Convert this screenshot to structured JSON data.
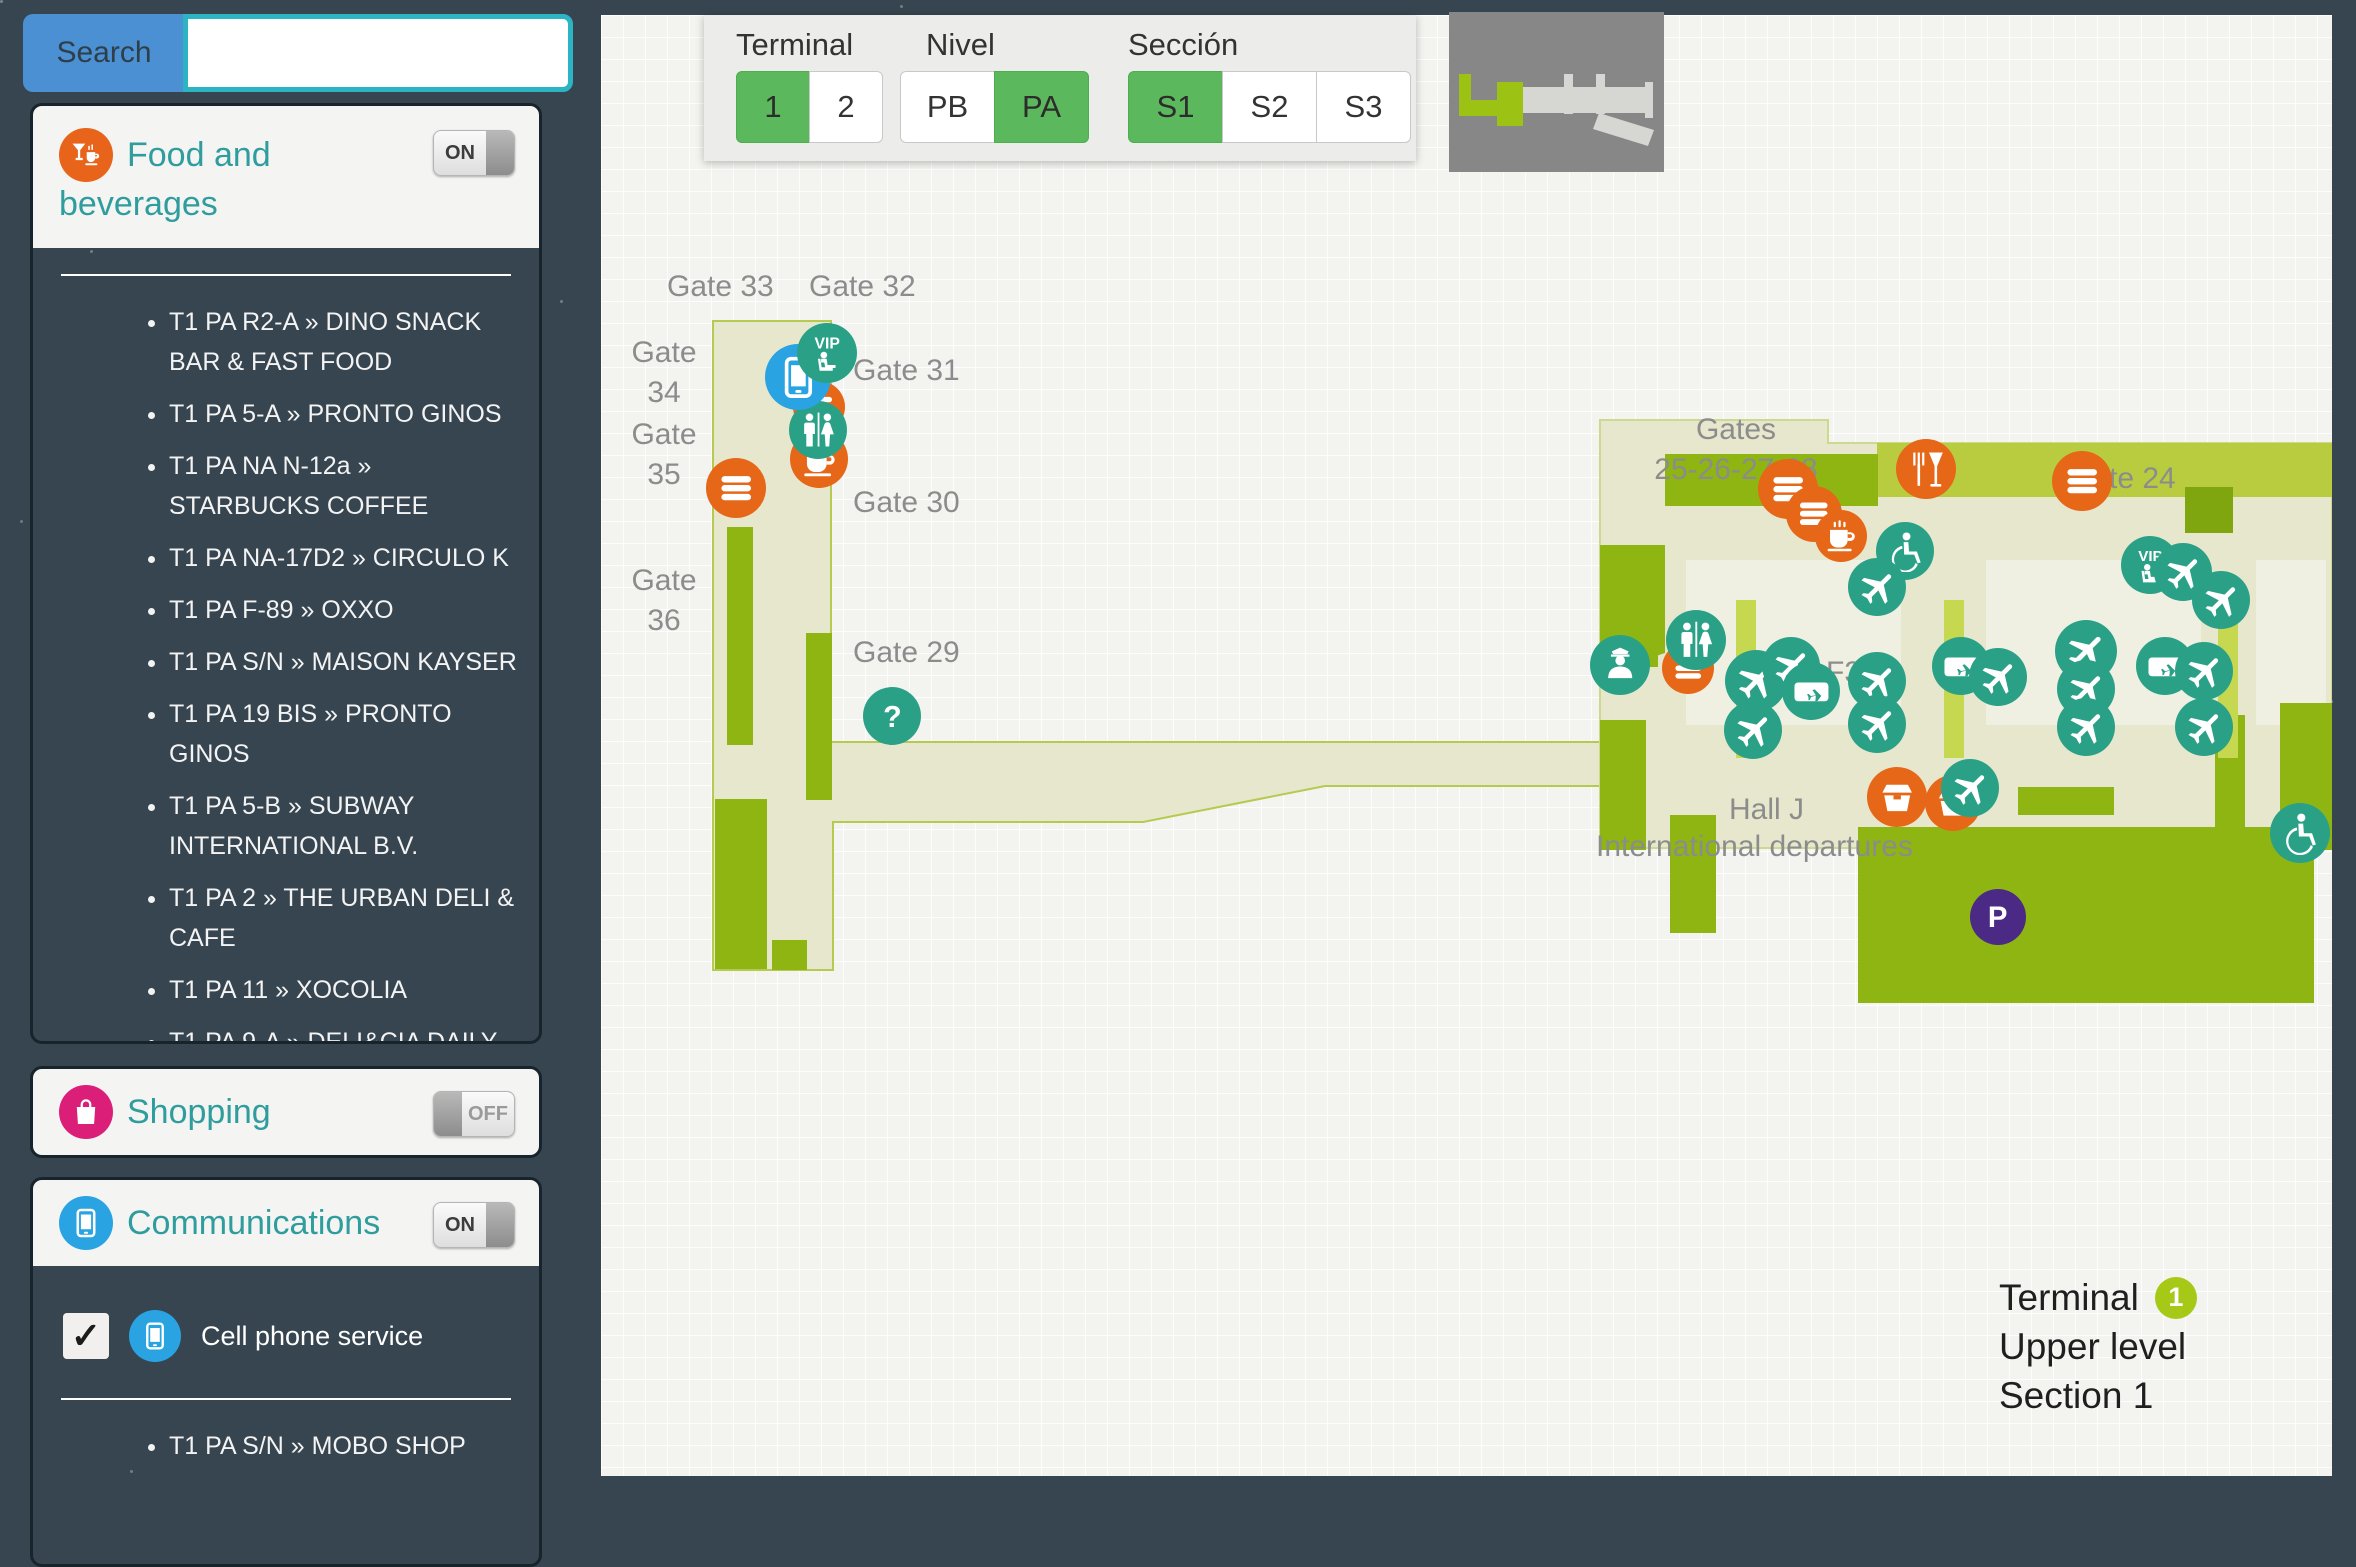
{
  "search": {
    "button_label": "Search",
    "value": ""
  },
  "sidebar": {
    "sections": [
      {
        "id": "food",
        "title": "Food and beverages",
        "toggle": "ON",
        "icon": "food-drinks-icon",
        "accent": "#e8641b",
        "items": [
          "T1 PA R2-A » DINO SNACK BAR & FAST FOOD",
          "T1 PA 5-A » PRONTO GINOS",
          "T1 PA NA N-12a » STARBUCKS COFFEE",
          "T1 PA NA-17D2 » CIRCULO K",
          "T1 PA F-89 » OXXO",
          "T1 PA S/N » MAISON KAYSER",
          "T1 PA 19 BIS » PRONTO GINOS",
          "T1 PA 5-B » SUBWAY INTERNATIONAL B.V.",
          "T1 PA 2 » THE URBAN DELI & CAFE",
          "T1 PA 11 » XOCOLIA",
          "T1 PA 9-A » DELI&CIA DAILY SMART FOOD"
        ]
      },
      {
        "id": "shopping",
        "title": "Shopping",
        "toggle": "OFF",
        "icon": "shopping-bag-icon",
        "accent": "#db1f79",
        "items": []
      },
      {
        "id": "communications",
        "title": "Communications",
        "toggle": "ON",
        "icon": "smartphone-icon",
        "accent": "#29a3e2",
        "subfilter": {
          "label": "Cell phone service",
          "checked": true,
          "check_glyph": "✓"
        },
        "items": [
          "T1 PA S/N » MOBO SHOP"
        ]
      }
    ]
  },
  "map_controls": {
    "groups": [
      {
        "label": "Terminal",
        "options": [
          {
            "label": "1",
            "active": true
          },
          {
            "label": "2",
            "active": false
          }
        ]
      },
      {
        "label": "Nivel",
        "options": [
          {
            "label": "PB",
            "active": false
          },
          {
            "label": "PA",
            "active": true
          }
        ]
      },
      {
        "label": "Sección",
        "options": [
          {
            "label": "S1",
            "active": true
          },
          {
            "label": "S2",
            "active": false
          },
          {
            "label": "S3",
            "active": false
          }
        ]
      }
    ]
  },
  "map": {
    "labels": {
      "gate33": "Gate 33",
      "gate32": "Gate 32",
      "gate34": "Gate\n34",
      "gate35": "Gate\n35",
      "gate36": "Gate\n36",
      "gate31": "Gate 31",
      "gate30": "Gate 30",
      "gate29": "Gate 29",
      "gates25_28": "Gates\n25-26-27-28",
      "gate24": "Gate 24",
      "hall_f3": "Hall F3",
      "hall_h1": "H",
      "hall_h2": "H",
      "hall_j": "Hall J",
      "intl": "International departures"
    },
    "info": {
      "line1": "Terminal",
      "badge": "1",
      "line2": "Upper level",
      "line3": "Section 1"
    },
    "colors": {
      "teal": "#2aa187",
      "orange": "#e56717",
      "blue": "#29a3e2",
      "purple": "#4b2a85",
      "green": "#8eb512",
      "light_green": "#b9cc40",
      "pale": "#e7e7cd",
      "badge_green": "#a6c816"
    },
    "markers": [
      {
        "icon": "burger",
        "color": "orange",
        "x": 218,
        "y": 392,
        "r": 26
      },
      {
        "icon": "coffee",
        "color": "orange",
        "x": 218,
        "y": 444,
        "r": 29
      },
      {
        "icon": "restroom",
        "color": "teal",
        "x": 217,
        "y": 415,
        "r": 29
      },
      {
        "icon": "phone",
        "color": "blue",
        "x": 197,
        "y": 362,
        "r": 33
      },
      {
        "icon": "vip",
        "color": "teal",
        "x": 226,
        "y": 338,
        "r": 30
      },
      {
        "icon": "burger",
        "color": "orange",
        "x": 135,
        "y": 473,
        "r": 30
      },
      {
        "icon": "question",
        "color": "teal",
        "x": 291,
        "y": 701,
        "r": 29
      },
      {
        "icon": "burger",
        "color": "orange",
        "x": 1187,
        "y": 474,
        "r": 30
      },
      {
        "icon": "burger",
        "color": "orange",
        "x": 1213,
        "y": 499,
        "r": 28
      },
      {
        "icon": "coffee",
        "color": "orange",
        "x": 1240,
        "y": 521,
        "r": 26
      },
      {
        "icon": "restaurant",
        "color": "orange",
        "x": 1325,
        "y": 454,
        "r": 30
      },
      {
        "icon": "burger",
        "color": "orange",
        "x": 1481,
        "y": 466,
        "r": 30
      },
      {
        "icon": "wheelchair",
        "color": "teal",
        "x": 1304,
        "y": 536,
        "r": 29
      },
      {
        "icon": "plane",
        "color": "teal",
        "x": 1276,
        "y": 572,
        "r": 29
      },
      {
        "icon": "vip",
        "color": "teal",
        "x": 1549,
        "y": 550,
        "r": 29
      },
      {
        "icon": "plane",
        "color": "teal",
        "x": 1582,
        "y": 557,
        "r": 29
      },
      {
        "icon": "plane",
        "color": "teal",
        "x": 1620,
        "y": 585,
        "r": 29
      },
      {
        "icon": "burger",
        "color": "orange",
        "x": 1087,
        "y": 653,
        "r": 26
      },
      {
        "icon": "restroom",
        "color": "teal",
        "x": 1095,
        "y": 625,
        "r": 30
      },
      {
        "icon": "police",
        "color": "teal",
        "x": 1019,
        "y": 650,
        "r": 30
      },
      {
        "icon": "plane",
        "color": "teal",
        "x": 1155,
        "y": 666,
        "r": 31
      },
      {
        "icon": "plane",
        "color": "teal",
        "x": 1190,
        "y": 651,
        "r": 29
      },
      {
        "icon": "ticket",
        "color": "teal",
        "x": 1210,
        "y": 676,
        "r": 29
      },
      {
        "icon": "plane",
        "color": "teal",
        "x": 1152,
        "y": 715,
        "r": 29
      },
      {
        "icon": "plane",
        "color": "teal",
        "x": 1276,
        "y": 666,
        "r": 29
      },
      {
        "icon": "plane",
        "color": "teal",
        "x": 1276,
        "y": 709,
        "r": 29
      },
      {
        "icon": "ticket",
        "color": "teal",
        "x": 1360,
        "y": 651,
        "r": 29
      },
      {
        "icon": "plane",
        "color": "teal",
        "x": 1397,
        "y": 662,
        "r": 29
      },
      {
        "icon": "plane",
        "color": "teal",
        "x": 1485,
        "y": 636,
        "r": 31
      },
      {
        "icon": "plane",
        "color": "teal",
        "x": 1485,
        "y": 674,
        "r": 29
      },
      {
        "icon": "plane",
        "color": "teal",
        "x": 1485,
        "y": 712,
        "r": 29
      },
      {
        "icon": "ticket",
        "color": "teal",
        "x": 1564,
        "y": 651,
        "r": 29
      },
      {
        "icon": "plane",
        "color": "teal",
        "x": 1603,
        "y": 656,
        "r": 29
      },
      {
        "icon": "plane",
        "color": "teal",
        "x": 1603,
        "y": 712,
        "r": 29
      },
      {
        "icon": "takeout",
        "color": "orange",
        "x": 1296,
        "y": 782,
        "r": 30
      },
      {
        "icon": "takeout",
        "color": "orange",
        "x": 1352,
        "y": 788,
        "r": 28
      },
      {
        "icon": "plane",
        "color": "teal",
        "x": 1369,
        "y": 773,
        "r": 29
      },
      {
        "icon": "wheelchair",
        "color": "teal",
        "x": 1699,
        "y": 818,
        "r": 30
      },
      {
        "icon": "parking",
        "color": "purple",
        "x": 1397,
        "y": 902,
        "r": 28
      }
    ]
  }
}
